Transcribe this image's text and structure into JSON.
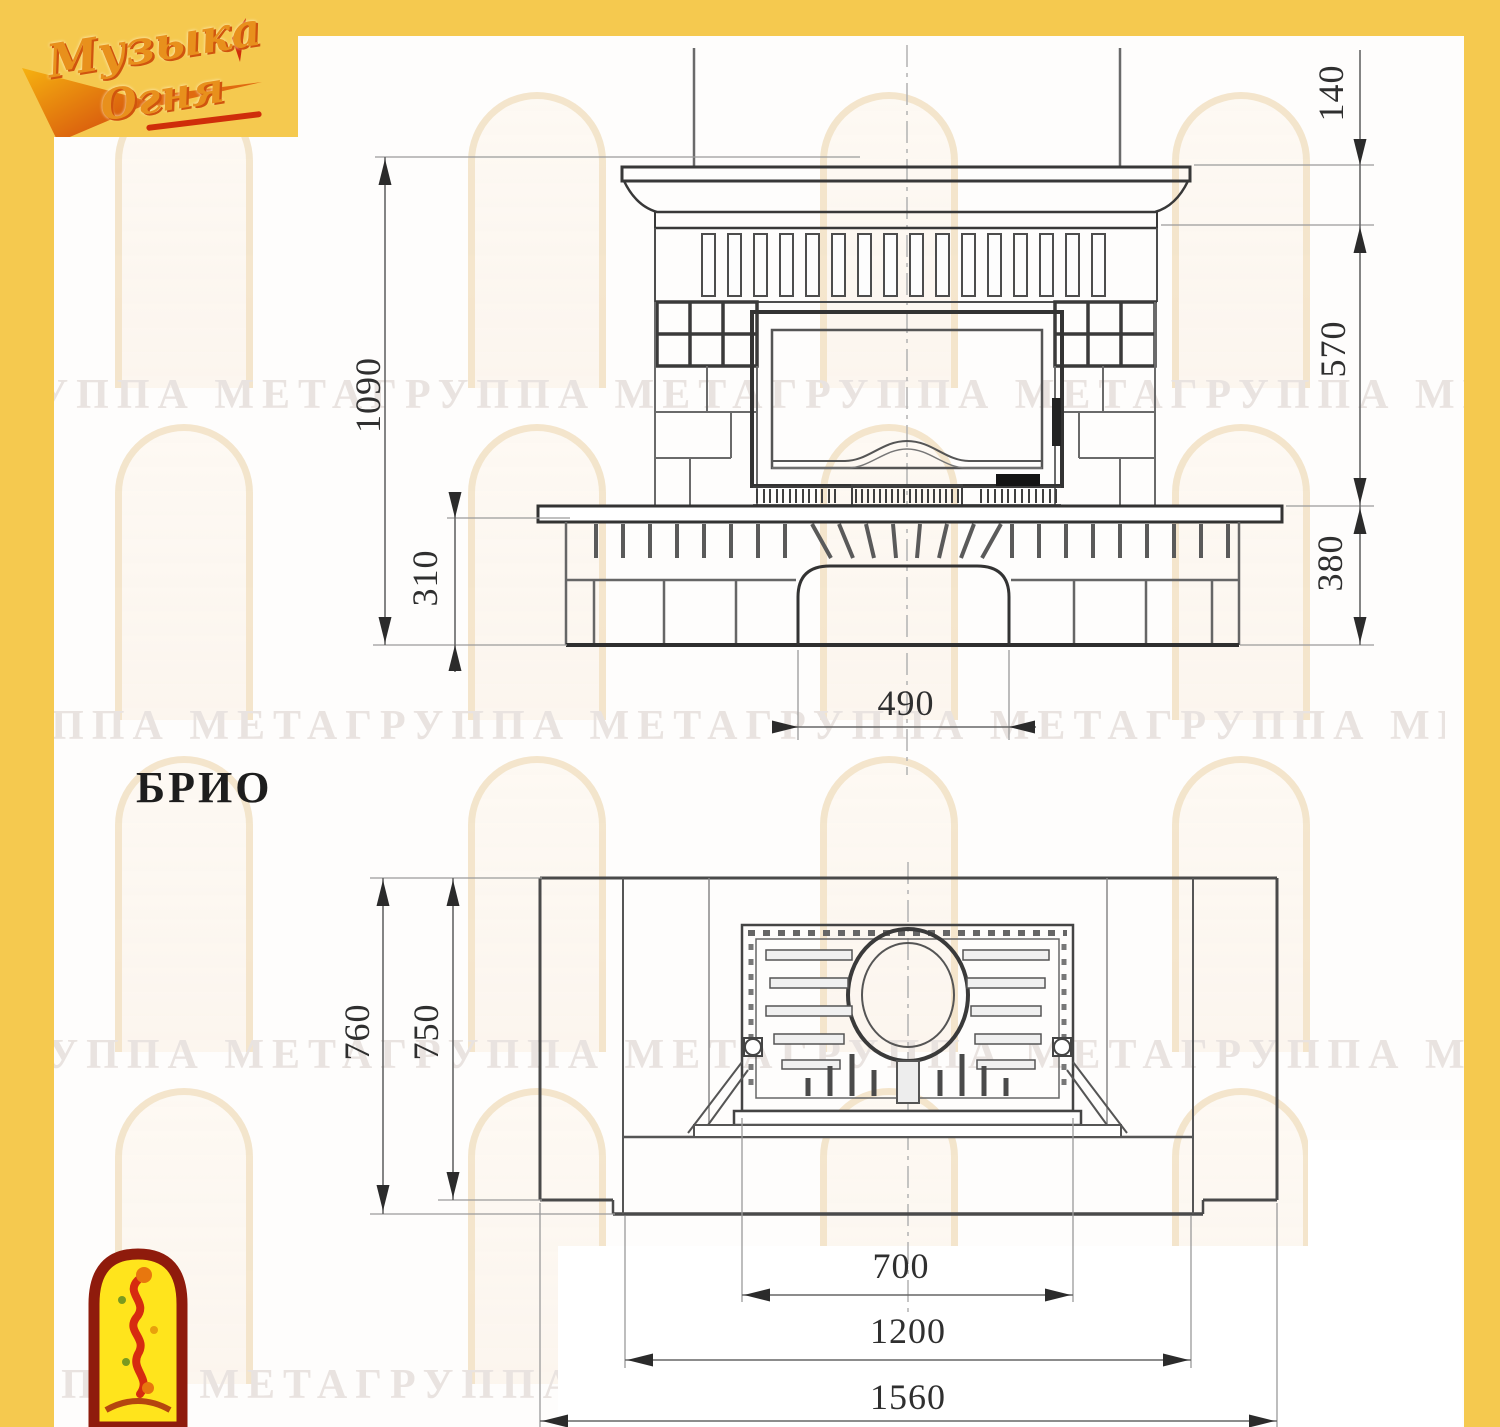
{
  "model": {
    "name": "БРИО"
  },
  "logo": {
    "line1": "Музыка",
    "line2": "Огня"
  },
  "watermark": {
    "text": "ГРУППА МЕТАГРУППА МЕТАГРУППА МЕТАГРУППА МЕТА"
  },
  "front_view": {
    "dims": {
      "total_height": "1090",
      "plinth_height": "310",
      "shelf_height": "140",
      "opening_height": "570",
      "hearth_height": "380",
      "niche_width": "490"
    }
  },
  "plan_view": {
    "dims": {
      "total_depth": "760",
      "body_depth": "750",
      "insert_width": "700",
      "front_width": "1200",
      "total_width": "1560"
    }
  },
  "colors": {
    "frame_yellow": "#f5c94f",
    "logo_orange": "#e8901c",
    "logo_red": "#cf2d0a",
    "mascot_border": "#8f1b0c",
    "mascot_fill": "#ffe41c",
    "drawing_line": "#4d4d4d",
    "watermark_text": "#e9e3e0",
    "watermark_cream": "#f3e2c6"
  }
}
